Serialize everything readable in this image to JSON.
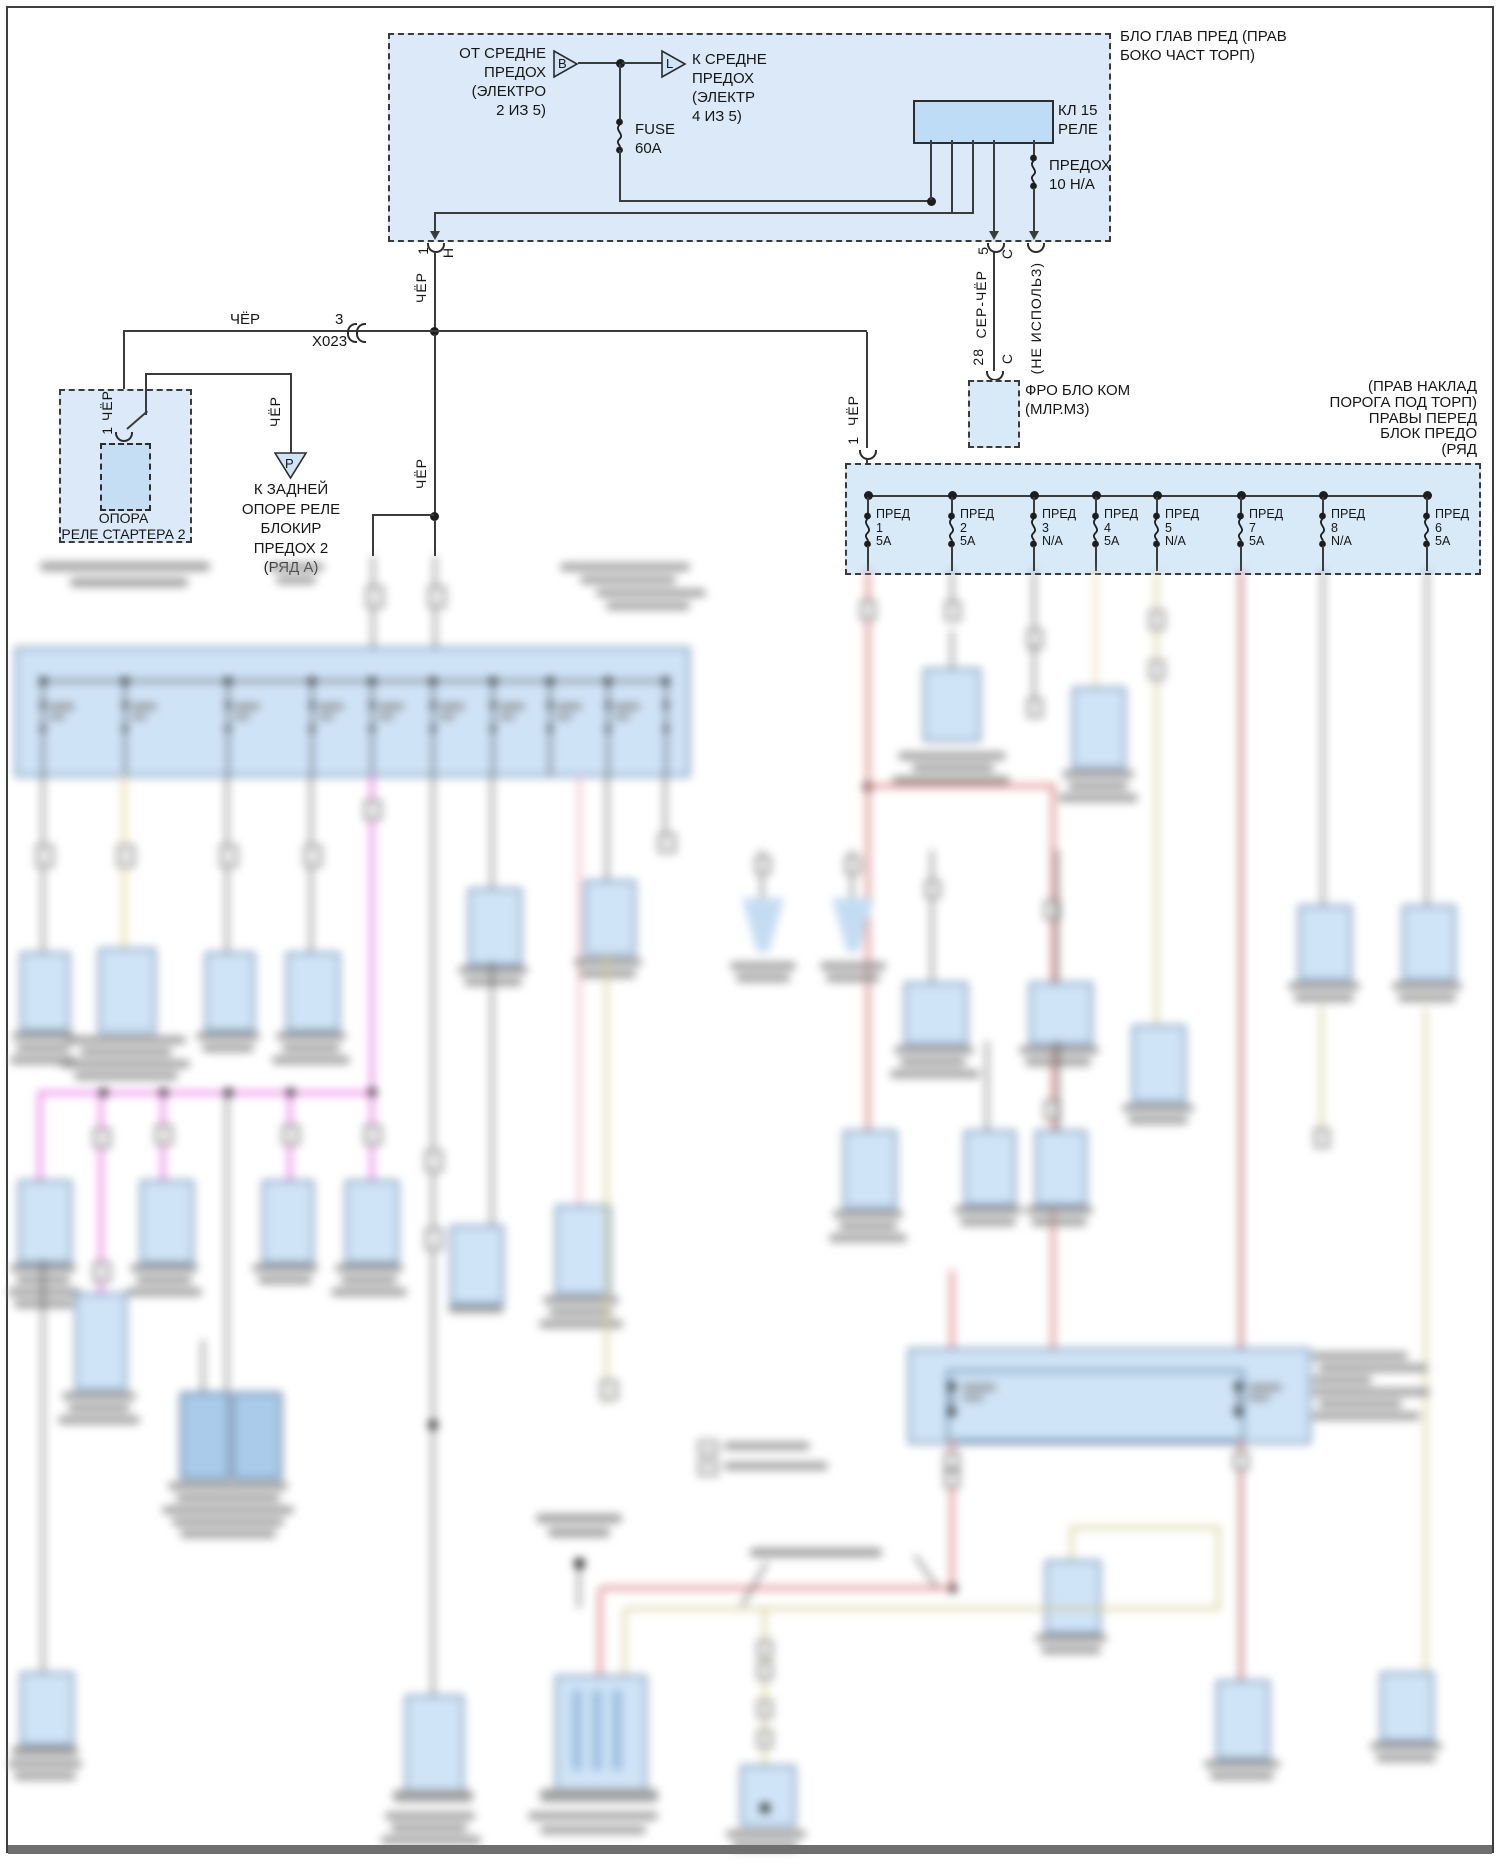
{
  "palette": {
    "panel_fill": "#dbe9f8",
    "component_fill": "#cfe4f7",
    "relay_fill": "#bedcf5",
    "wire_black": "#3b3b3b",
    "wire_red": "#de8888",
    "wire_magenta": "#ea7de4",
    "wire_tan": "#e8d6a4",
    "wire_olive": "#d2cb92",
    "wire_pink": "#efb0bd",
    "wire_darkred": "#c47c7c"
  },
  "top_box": {
    "title": [
      "БЛО ГЛАВ ПРЕД (ПРАВ",
      "БОКО ЧАСТ ТОРП)"
    ],
    "from_label": [
      "ОТ СРЕДНЕ",
      "ПРЕДОХ",
      "(ЭЛЕКТРО",
      "2 ИЗ 5)"
    ],
    "to_label": [
      "К СРЕДНЕ",
      "ПРЕДОХ",
      "(ЭЛЕКТР",
      "4 ИЗ 5)"
    ],
    "tri_from": "B",
    "tri_to": "L",
    "fuse_main": [
      "FUSE",
      "60A"
    ],
    "relay": [
      "КЛ 15",
      "РЕЛЕ"
    ],
    "relay_fuse": [
      "ПРЕДОХ",
      "10 Н/А"
    ]
  },
  "exit": {
    "pin": "1",
    "conn": "Н"
  },
  "wires": {
    "cher": "ЧЁР",
    "ser_cher": "СЕР-ЧЁР"
  },
  "x023": {
    "pin": "3",
    "name": "X023"
  },
  "klemma": {
    "pin_top": "5",
    "conn": "С",
    "pin_bottom": "28",
    "not_used": "(НЕ ИСПОЛЬЗ)"
  },
  "fro_box": {
    "line1": "ФРО БЛО КОМ",
    "line2": "(МЛР.М3)"
  },
  "starter": {
    "pin_label": "1 ЧЁР",
    "line1": "ОПОРА",
    "line2": "РЕЛЕ СТАРТЕРА 2"
  },
  "ground_p": {
    "letter": "P",
    "wire": "ЧЁР",
    "lines": [
      "К ЗАДНЕЙ",
      "ОПОРЕ РЕЛЕ",
      "БЛОКИР",
      "ПРЕДОХ 2",
      "(РЯД А)"
    ]
  },
  "right_fuse_box": {
    "title": [
      "(ПРАВ НАКЛАД",
      "ПОРОГА ПОД ТОРП)",
      "ПРАВЫ ПЕРЕД",
      "БЛОК ПРЕДО",
      "(РЯД"
    ],
    "entry_pin": "1",
    "fuse_word": "ПРЕД",
    "fuses": [
      {
        "num": "1",
        "amp": "5А"
      },
      {
        "num": "2",
        "amp": "5А"
      },
      {
        "num": "3",
        "amp": "N/A"
      },
      {
        "num": "4",
        "amp": "5А"
      },
      {
        "num": "5",
        "amp": "N/A"
      },
      {
        "num": "7",
        "amp": "5А"
      },
      {
        "num": "8",
        "amp": "N/A"
      },
      {
        "num": "6",
        "amp": "5А"
      }
    ]
  }
}
